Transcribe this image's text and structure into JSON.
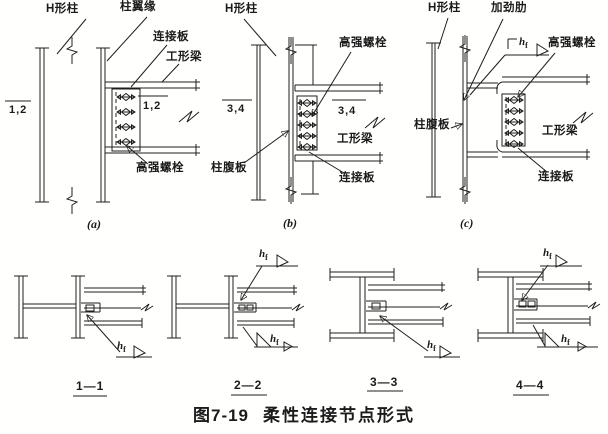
{
  "colors": {
    "ink": "#1f1f1f",
    "paper": "#fffffd"
  },
  "caption": {
    "number": "图7-19",
    "title": "柔性连接节点形式"
  },
  "weld_label": {
    "h": "h",
    "f": "f"
  },
  "panels": {
    "a": {
      "tag": "(a)",
      "h_column": "H形柱",
      "column_flange": "柱翼缘",
      "connection_plate": "连接板",
      "i_beam": "工形梁",
      "bolts": "高强螺栓",
      "section_left": "1,2",
      "section_right": "1,2"
    },
    "b": {
      "tag": "(b)",
      "h_column": "H形柱",
      "bolts": "高强螺栓",
      "column_web": "柱腹板",
      "connection_plate": "连接板",
      "i_beam": "工形梁",
      "section_left": "3,4",
      "section_right": "3,4"
    },
    "c": {
      "tag": "(c)",
      "h_column": "H形柱",
      "stiffener": "加劲肋",
      "bolts": "高强螺栓",
      "column_web": "柱腹板",
      "connection_plate": "连接板",
      "i_beam": "工形梁"
    }
  },
  "sections": {
    "s1": {
      "label": "1—1"
    },
    "s2": {
      "label": "2—2"
    },
    "s3": {
      "label": "3—3"
    },
    "s4": {
      "label": "4—4"
    }
  }
}
